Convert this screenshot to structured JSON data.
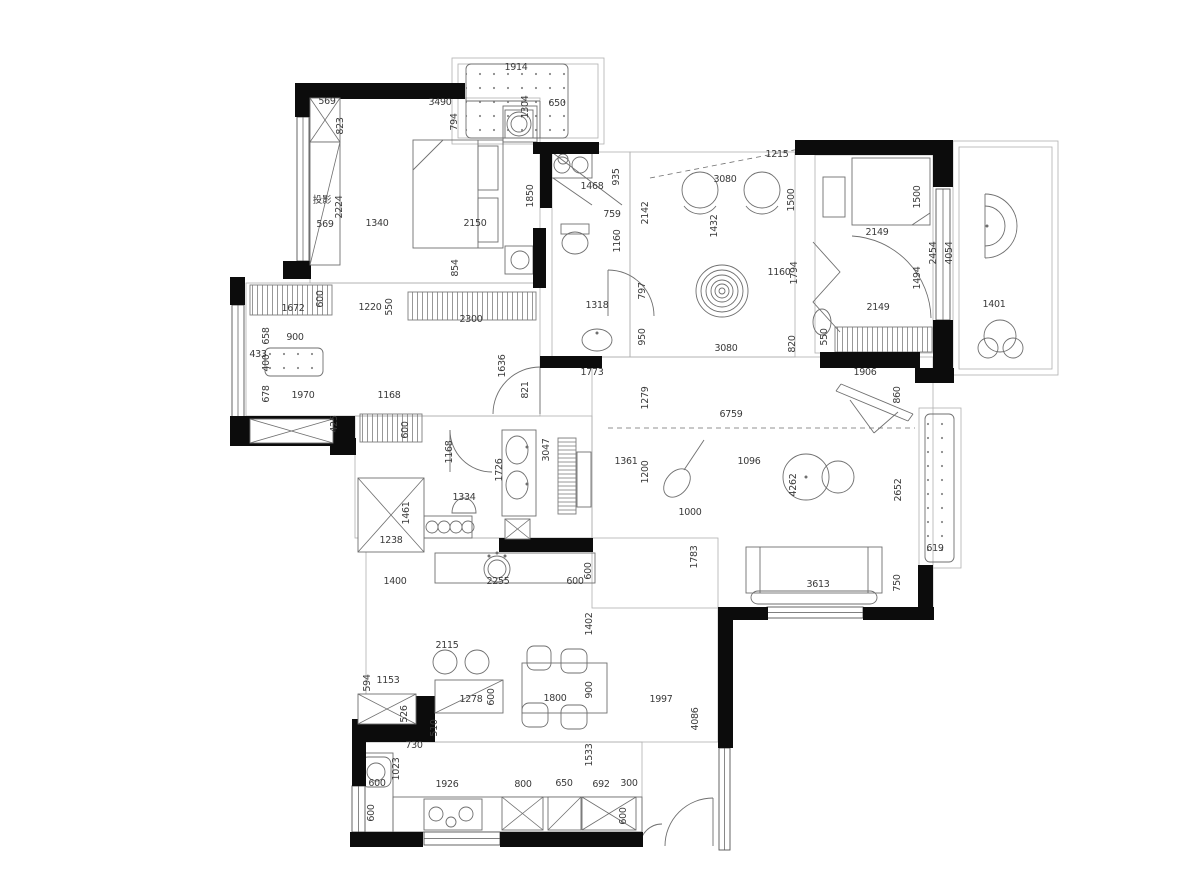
{
  "colors": {
    "wall": "#0c0c0c",
    "furniture_line": "#6f6f6f",
    "room_line": "#b0b0b0",
    "window_line": "#555555",
    "hatch_line": "#7d7d7d",
    "label_text": "#3a3a3a",
    "background": "#ffffff"
  },
  "plan": {
    "walls": [
      [
        295,
        83,
        170,
        16
      ],
      [
        295,
        83,
        16,
        34
      ],
      [
        283,
        261,
        28,
        18
      ],
      [
        533,
        142,
        66,
        12
      ],
      [
        540,
        142,
        12,
        66
      ],
      [
        533,
        228,
        13,
        60
      ],
      [
        540,
        356,
        62,
        12
      ],
      [
        795,
        140,
        158,
        15
      ],
      [
        933,
        153,
        20,
        34
      ],
      [
        933,
        320,
        20,
        48
      ],
      [
        820,
        352,
        100,
        16
      ],
      [
        915,
        368,
        39,
        15
      ],
      [
        918,
        565,
        15,
        46
      ],
      [
        863,
        607,
        71,
        13
      ],
      [
        718,
        607,
        50,
        13
      ],
      [
        718,
        607,
        15,
        141
      ],
      [
        230,
        277,
        15,
        28
      ],
      [
        230,
        416,
        125,
        30
      ],
      [
        330,
        438,
        26,
        17
      ],
      [
        499,
        538,
        94,
        14
      ],
      [
        415,
        696,
        20,
        26
      ],
      [
        352,
        719,
        83,
        23
      ],
      [
        352,
        742,
        14,
        44
      ],
      [
        350,
        832,
        73,
        15
      ],
      [
        500,
        832,
        143,
        15
      ]
    ],
    "windows": [
      [
        297,
        117,
        12,
        144
      ],
      [
        232,
        305,
        12,
        112
      ],
      [
        936,
        189,
        14,
        131
      ],
      [
        767,
        607,
        96,
        11
      ],
      [
        424,
        832,
        76,
        13
      ],
      [
        352,
        786,
        13,
        46
      ],
      [
        719,
        748,
        11,
        102
      ]
    ],
    "rooms": [
      [
        310,
        98,
        230,
        185
      ],
      [
        552,
        152,
        78,
        205
      ],
      [
        630,
        152,
        165,
        205
      ],
      [
        815,
        155,
        118,
        198
      ],
      [
        953,
        141,
        105,
        234
      ],
      [
        959,
        147,
        93,
        222
      ],
      [
        452,
        58,
        152,
        86
      ],
      [
        458,
        64,
        140,
        74
      ],
      [
        246,
        283,
        294,
        133
      ],
      [
        592,
        357,
        341,
        251
      ],
      [
        355,
        416,
        237,
        122
      ],
      [
        366,
        538,
        352,
        204
      ],
      [
        362,
        742,
        280,
        90
      ],
      [
        919,
        408,
        42,
        160
      ]
    ],
    "hatch_v": [
      [
        250,
        285,
        82,
        30
      ],
      [
        408,
        292,
        128,
        28
      ],
      [
        360,
        414,
        62,
        28
      ],
      [
        835,
        327,
        97,
        25
      ]
    ],
    "hatch_h": [
      [
        558,
        438,
        18,
        76
      ]
    ],
    "dot_rects": [
      [
        466,
        64,
        102,
        74
      ],
      [
        925,
        414,
        29,
        148
      ],
      [
        265,
        348,
        58,
        28
      ]
    ],
    "x_cross": [
      [
        310,
        98,
        30,
        44
      ],
      [
        250,
        419,
        83,
        24
      ],
      [
        358,
        478,
        66,
        74
      ],
      [
        358,
        694,
        58,
        30
      ],
      [
        502,
        797,
        41,
        33
      ],
      [
        582,
        797,
        54,
        33
      ],
      [
        505,
        519,
        25,
        20
      ]
    ],
    "x_single": [
      [
        310,
        142,
        30,
        123
      ],
      [
        435,
        680,
        68,
        33
      ],
      [
        548,
        797,
        33,
        33
      ]
    ],
    "rects": [
      [
        413,
        140,
        90,
        108
      ],
      [
        478,
        146,
        20,
        44
      ],
      [
        478,
        198,
        20,
        44
      ],
      [
        505,
        110,
        28,
        28
      ],
      [
        505,
        246,
        28,
        28
      ],
      [
        852,
        158,
        78,
        67
      ],
      [
        823,
        177,
        22,
        40
      ],
      [
        746,
        547,
        136,
        46
      ],
      [
        550,
        152,
        42,
        26
      ],
      [
        424,
        516,
        48,
        22
      ],
      [
        502,
        430,
        34,
        86
      ],
      [
        435,
        553,
        160,
        30
      ],
      [
        577,
        452,
        14,
        55
      ],
      [
        362,
        753,
        31,
        79
      ],
      [
        393,
        797,
        249,
        35
      ],
      [
        424,
        799,
        58,
        31
      ],
      [
        522,
        663,
        85,
        50
      ],
      [
        503,
        106,
        34,
        36
      ],
      [
        561,
        224,
        28,
        10
      ],
      [
        550,
        800,
        28,
        27
      ]
    ],
    "round_rects": [
      [
        751,
        591,
        126,
        13
      ],
      [
        361,
        757,
        30,
        30
      ],
      [
        527,
        646,
        24,
        24
      ],
      [
        561,
        649,
        26,
        24
      ],
      [
        522,
        703,
        26,
        24
      ],
      [
        561,
        705,
        26,
        24
      ]
    ],
    "circles": [
      [
        562,
        165,
        8
      ],
      [
        580,
        165,
        8
      ],
      [
        519,
        124,
        12
      ],
      [
        519,
        124,
        8
      ],
      [
        520,
        260,
        9
      ],
      [
        700,
        190,
        18
      ],
      [
        762,
        190,
        18
      ],
      [
        722,
        291,
        26
      ],
      [
        722,
        291,
        21
      ],
      [
        722,
        291,
        16
      ],
      [
        722,
        291,
        11
      ],
      [
        722,
        291,
        7
      ],
      [
        722,
        291,
        3
      ],
      [
        806,
        477,
        23
      ],
      [
        838,
        477,
        16
      ],
      [
        497,
        569,
        13
      ],
      [
        497,
        569,
        9
      ],
      [
        432,
        527,
        6
      ],
      [
        444,
        527,
        6
      ],
      [
        456,
        527,
        6
      ],
      [
        468,
        527,
        6
      ],
      [
        436,
        814,
        7
      ],
      [
        466,
        814,
        7
      ],
      [
        451,
        822,
        5
      ],
      [
        445,
        662,
        12
      ],
      [
        477,
        662,
        12
      ],
      [
        376,
        772,
        9
      ],
      [
        1000,
        336,
        16
      ],
      [
        988,
        348,
        10
      ],
      [
        1013,
        348,
        10
      ],
      [
        563,
        159,
        5
      ]
    ],
    "dots_small": [
      [
        489,
        556
      ],
      [
        497,
        553
      ],
      [
        505,
        556
      ],
      [
        527,
        447
      ],
      [
        527,
        484
      ],
      [
        597,
        333
      ],
      [
        806,
        477
      ],
      [
        987,
        226
      ]
    ],
    "ellipses": [
      [
        575,
        243,
        13,
        11,
        0
      ],
      [
        597,
        340,
        15,
        11,
        0
      ],
      [
        822,
        322,
        9,
        13,
        0
      ],
      [
        517,
        450,
        11,
        14,
        0
      ],
      [
        517,
        485,
        11,
        14,
        0
      ],
      [
        677,
        483,
        11,
        16,
        40
      ]
    ],
    "lines": [
      [
        413,
        170,
        443,
        140
      ],
      [
        478,
        140,
        478,
        248
      ],
      [
        912,
        225,
        930,
        213
      ],
      [
        760,
        547,
        760,
        593
      ],
      [
        868,
        547,
        868,
        593
      ],
      [
        836,
        391,
        908,
        421
      ],
      [
        841,
        384,
        913,
        414
      ],
      [
        836,
        391,
        841,
        384
      ],
      [
        908,
        421,
        913,
        414
      ],
      [
        850,
        400,
        874,
        433
      ],
      [
        874,
        433,
        898,
        412
      ],
      [
        684,
        470,
        704,
        440
      ],
      [
        553,
        153,
        622,
        205
      ],
      [
        553,
        178,
        592,
        205
      ],
      [
        466,
        101,
        540,
        101
      ],
      [
        540,
        101,
        540,
        138
      ],
      [
        608,
        270,
        608,
        316
      ],
      [
        540,
        367,
        540,
        414
      ],
      [
        450,
        430,
        450,
        472
      ],
      [
        713,
        798,
        713,
        846
      ],
      [
        985,
        194,
        985,
        258
      ]
    ],
    "dashes": [
      [
        608,
        428,
        915,
        428
      ],
      [
        650,
        178,
        820,
        145
      ]
    ],
    "paths": [
      "M608,270 A46,46 0 0 1 654,316",
      "M493,414 A47,47 0 0 1 540,367",
      "M450,430 A42,42 0 0 0 492,472",
      "M713,798 A48,48 0 0 0 665,846",
      "M640,846 A22,22 0 0 1 662,824",
      "M852,236 A84,84 0 0 1 931,318",
      "M813,242 L840,272 L813,302 L840,332",
      "M985,194 A32,32 0 1 1 985,258",
      "M985,206 A20,20 0 1 1 985,246",
      "M452,513 A12,15 0 0 1 476,513 Z",
      "M684,206 A20,20 0 0 0 716,206",
      "M746,206 A20,20 0 0 0 778,206"
    ],
    "labels": [
      [
        "1914",
        516,
        70,
        0
      ],
      [
        "569",
        327,
        104,
        0
      ],
      [
        "3490",
        440,
        105,
        0
      ],
      [
        "650",
        557,
        106,
        0
      ],
      [
        "1304",
        528,
        107,
        1
      ],
      [
        "794",
        457,
        122,
        1
      ],
      [
        "823",
        343,
        126,
        1
      ],
      [
        "1850",
        533,
        196,
        1
      ],
      [
        "2224",
        342,
        207,
        1
      ],
      [
        "投影",
        322,
        203,
        0
      ],
      [
        "569",
        325,
        227,
        0
      ],
      [
        "1340",
        377,
        226,
        0
      ],
      [
        "2150",
        475,
        226,
        0
      ],
      [
        "854",
        458,
        268,
        1
      ],
      [
        "1468",
        592,
        189,
        0
      ],
      [
        "935",
        619,
        177,
        1
      ],
      [
        "759",
        612,
        217,
        0
      ],
      [
        "1160",
        620,
        241,
        1
      ],
      [
        "2142",
        648,
        213,
        1
      ],
      [
        "1318",
        597,
        308,
        0
      ],
      [
        "797",
        645,
        291,
        1
      ],
      [
        "950",
        645,
        337,
        1
      ],
      [
        "1773",
        592,
        375,
        0
      ],
      [
        "1215",
        777,
        157,
        0
      ],
      [
        "3080",
        725,
        182,
        0
      ],
      [
        "1432",
        717,
        226,
        1
      ],
      [
        "1500",
        794,
        200,
        1
      ],
      [
        "1160",
        779,
        275,
        0
      ],
      [
        "1794",
        797,
        273,
        1
      ],
      [
        "820",
        795,
        344,
        1
      ],
      [
        "3080",
        726,
        351,
        0
      ],
      [
        "1500",
        920,
        197,
        1
      ],
      [
        "2149",
        877,
        235,
        0
      ],
      [
        "2454",
        936,
        253,
        1
      ],
      [
        "4054",
        952,
        253,
        1
      ],
      [
        "1494",
        920,
        278,
        1
      ],
      [
        "2149",
        878,
        310,
        0
      ],
      [
        "550",
        827,
        337,
        1
      ],
      [
        "1906",
        865,
        375,
        0
      ],
      [
        "1401",
        994,
        307,
        0
      ],
      [
        "1672",
        293,
        311,
        0
      ],
      [
        "600",
        323,
        299,
        1
      ],
      [
        "1220",
        370,
        310,
        0
      ],
      [
        "550",
        392,
        307,
        1
      ],
      [
        "2300",
        471,
        322,
        0
      ],
      [
        "658",
        269,
        336,
        1
      ],
      [
        "900",
        295,
        340,
        0
      ],
      [
        "433",
        258,
        357,
        0
      ],
      [
        "400",
        269,
        363,
        1
      ],
      [
        "678",
        269,
        394,
        1
      ],
      [
        "1970",
        303,
        398,
        0
      ],
      [
        "1168",
        389,
        398,
        0
      ],
      [
        "1636",
        505,
        366,
        1
      ],
      [
        "821",
        528,
        390,
        1
      ],
      [
        "425",
        337,
        424,
        1
      ],
      [
        "600",
        408,
        430,
        1
      ],
      [
        "1168",
        452,
        452,
        1
      ],
      [
        "1726",
        502,
        470,
        1
      ],
      [
        "3047",
        549,
        450,
        1
      ],
      [
        "1334",
        464,
        500,
        0
      ],
      [
        "1461",
        409,
        513,
        1
      ],
      [
        "1238",
        391,
        543,
        0
      ],
      [
        "1400",
        395,
        584,
        0
      ],
      [
        "2255",
        498,
        584,
        0
      ],
      [
        "600",
        575,
        584,
        0
      ],
      [
        "600",
        591,
        571,
        1
      ],
      [
        "1279",
        648,
        398,
        1
      ],
      [
        "6759",
        731,
        417,
        0
      ],
      [
        "860",
        900,
        395,
        1
      ],
      [
        "1361",
        626,
        464,
        0
      ],
      [
        "1200",
        648,
        472,
        1
      ],
      [
        "1096",
        749,
        464,
        0
      ],
      [
        "4262",
        796,
        485,
        1
      ],
      [
        "2652",
        901,
        490,
        1
      ],
      [
        "1000",
        690,
        515,
        0
      ],
      [
        "1783",
        697,
        557,
        1
      ],
      [
        "3613",
        818,
        587,
        0
      ],
      [
        "750",
        900,
        583,
        1
      ],
      [
        "619",
        935,
        551,
        0
      ],
      [
        "4086",
        698,
        719,
        1
      ],
      [
        "1997",
        661,
        702,
        0
      ],
      [
        "1402",
        592,
        624,
        1
      ],
      [
        "2115",
        447,
        648,
        0
      ],
      [
        "594",
        370,
        683,
        1
      ],
      [
        "1153",
        388,
        683,
        0
      ],
      [
        "1278",
        471,
        702,
        0
      ],
      [
        "600",
        494,
        697,
        1
      ],
      [
        "526",
        407,
        714,
        1
      ],
      [
        "510",
        437,
        728,
        1
      ],
      [
        "1800",
        555,
        701,
        0
      ],
      [
        "900",
        592,
        690,
        1
      ],
      [
        "730",
        414,
        748,
        0
      ],
      [
        "1023",
        399,
        769,
        1
      ],
      [
        "600",
        377,
        786,
        0
      ],
      [
        "1926",
        447,
        787,
        0
      ],
      [
        "800",
        523,
        787,
        0
      ],
      [
        "650",
        564,
        786,
        0
      ],
      [
        "692",
        601,
        787,
        0
      ],
      [
        "300",
        629,
        786,
        0
      ],
      [
        "1533",
        592,
        755,
        1
      ],
      [
        "600",
        374,
        813,
        1
      ],
      [
        "600",
        626,
        816,
        1
      ]
    ]
  }
}
